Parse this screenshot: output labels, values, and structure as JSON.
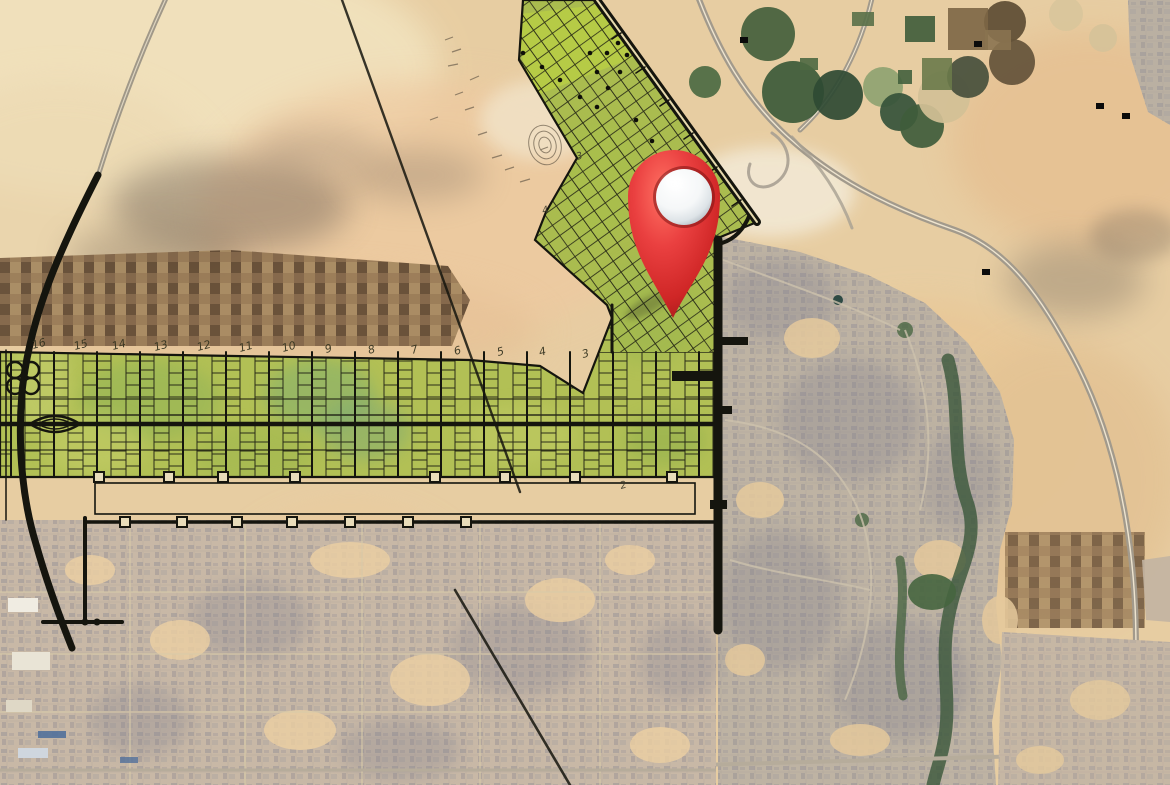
{
  "scene": {
    "type": "satellite-map-with-masterplan-overlay",
    "description": "Desert satellite map showing a yellow-green land subdivision master plan overlay with black planned road grid, numbered plot columns, pivot-irrigation crop circles in the desert, surrounding city districts, and a red 3D location pin marker",
    "location_pin": {
      "x": 674,
      "y": 196,
      "tip_y": 318,
      "head_radius": 46,
      "ball_radius": 28,
      "red": "#d92c2c",
      "red_dark": "#8e1414",
      "red_light": "#ff7163",
      "ball_color": "#ffffff"
    }
  },
  "plan": {
    "green_fill": "#b2c055",
    "arm_fill": "#aabc4f",
    "line_color": "#15150e",
    "plot_numbers": [
      {
        "label": "16",
        "x": 33,
        "y": 349
      },
      {
        "label": "15",
        "x": 75,
        "y": 350
      },
      {
        "label": "14",
        "x": 113,
        "y": 350
      },
      {
        "label": "13",
        "x": 155,
        "y": 351
      },
      {
        "label": "12",
        "x": 198,
        "y": 351
      },
      {
        "label": "11",
        "x": 240,
        "y": 352
      },
      {
        "label": "10",
        "x": 283,
        "y": 352
      },
      {
        "label": "9",
        "x": 326,
        "y": 353
      },
      {
        "label": "8",
        "x": 369,
        "y": 354
      },
      {
        "label": "7",
        "x": 412,
        "y": 354
      },
      {
        "label": "6",
        "x": 455,
        "y": 355
      },
      {
        "label": "5",
        "x": 498,
        "y": 356
      },
      {
        "label": "4",
        "x": 540,
        "y": 356
      },
      {
        "label": "3",
        "x": 583,
        "y": 358
      }
    ],
    "edge_labels": [
      {
        "label": "3",
        "x": 577,
        "y": 160
      },
      {
        "label": "4",
        "x": 543,
        "y": 214
      },
      {
        "label": "2",
        "x": 621,
        "y": 489
      }
    ],
    "node_squares_y478": [
      99,
      169,
      223,
      295,
      435,
      505,
      575,
      672
    ],
    "node_squares_y522": [
      125,
      182,
      237,
      292,
      350,
      408,
      466
    ],
    "arm_dots": [
      [
        618,
        43
      ],
      [
        627,
        55
      ],
      [
        607,
        53
      ],
      [
        597,
        72
      ],
      [
        620,
        72
      ],
      [
        608,
        88
      ],
      [
        590,
        53
      ],
      [
        542,
        67
      ],
      [
        523,
        53
      ],
      [
        560,
        80
      ],
      [
        580,
        97
      ],
      [
        597,
        107
      ],
      [
        636,
        120
      ],
      [
        652,
        141
      ],
      [
        664,
        160
      ]
    ]
  },
  "satellite": {
    "sand": "#e7cda2",
    "sand_light": "#f1e2bd",
    "sand_pink": "#eec9a0",
    "urban_gray": "#8e8b94",
    "highway_gray": "#a29a8c",
    "field_brown": "#7b5f43",
    "irrigation_circles": [
      {
        "x": 768,
        "y": 34,
        "r": 27,
        "c": "#44603c"
      },
      {
        "x": 793,
        "y": 92,
        "r": 31,
        "c": "#3c5a38"
      },
      {
        "x": 838,
        "y": 95,
        "r": 25,
        "c": "#2f4a33"
      },
      {
        "x": 883,
        "y": 87,
        "r": 20,
        "c": "#8fa371"
      },
      {
        "x": 899,
        "y": 112,
        "r": 19,
        "c": "#35523a"
      },
      {
        "x": 922,
        "y": 126,
        "r": 22,
        "c": "#3f5c3b"
      },
      {
        "x": 944,
        "y": 97,
        "r": 26,
        "c": "#d3c096"
      },
      {
        "x": 968,
        "y": 77,
        "r": 21,
        "c": "#474f3c"
      },
      {
        "x": 1005,
        "y": 22,
        "r": 21,
        "c": "#5d4c33"
      },
      {
        "x": 1012,
        "y": 62,
        "r": 23,
        "c": "#64523a"
      },
      {
        "x": 705,
        "y": 82,
        "r": 16,
        "c": "#4c6a42"
      },
      {
        "x": 1066,
        "y": 14,
        "r": 17,
        "c": "#d9c69b"
      },
      {
        "x": 1103,
        "y": 38,
        "r": 14,
        "c": "#d6c299"
      }
    ],
    "farm_rects": [
      {
        "x": 905,
        "y": 16,
        "w": 30,
        "h": 26,
        "c": "#3e5c3a"
      },
      {
        "x": 922,
        "y": 58,
        "w": 30,
        "h": 32,
        "c": "#6a7a4a"
      },
      {
        "x": 898,
        "y": 70,
        "w": 14,
        "h": 14,
        "c": "#42603d"
      },
      {
        "x": 948,
        "y": 8,
        "w": 40,
        "h": 42,
        "c": "#7c6645"
      },
      {
        "x": 985,
        "y": 30,
        "w": 26,
        "h": 20,
        "c": "#8a7350"
      },
      {
        "x": 852,
        "y": 12,
        "w": 22,
        "h": 14,
        "c": "#597048"
      },
      {
        "x": 800,
        "y": 58,
        "w": 18,
        "h": 12,
        "c": "#4d6841"
      }
    ],
    "black_marks": [
      [
        744,
        40
      ],
      [
        978,
        44
      ],
      [
        986,
        272
      ],
      [
        1100,
        106
      ],
      [
        1126,
        116
      ]
    ]
  }
}
